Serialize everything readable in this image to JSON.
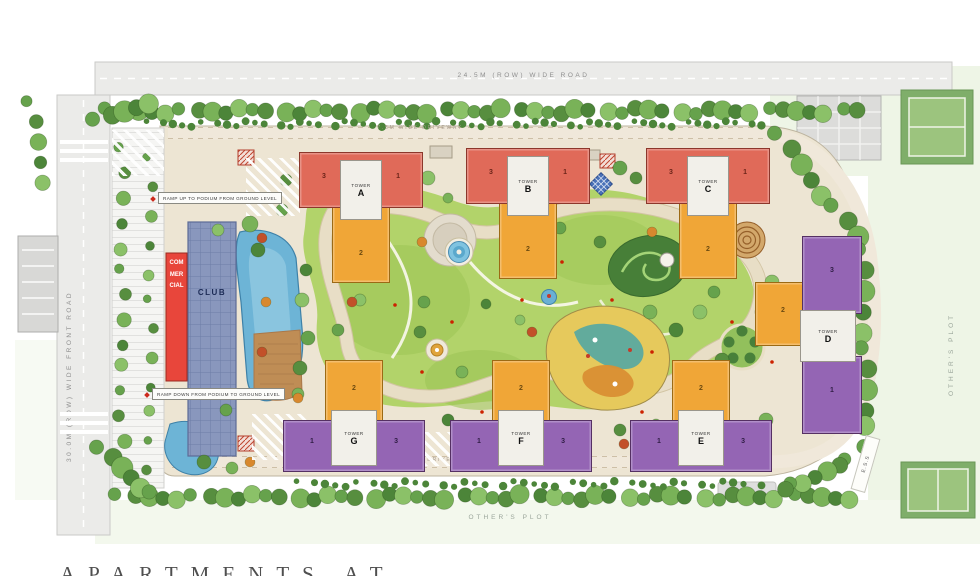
{
  "roads": {
    "top": "24.5M (ROW) WIDE ROAD",
    "left": "30.0M (ROW) WIDE FRONT ROAD",
    "driveway_top": "7.5M WIDE DRIVEWAY",
    "driveway_bottom": "7.5M WIDE DRIVEWAY"
  },
  "ramps": {
    "up": "RAMP UP TO PODIUM FROM GROUND LEVEL",
    "down": "RAMP DOWN FROM PODIUM TO GROUND LEVEL"
  },
  "club": {
    "label": "CLUB"
  },
  "commercial": {
    "label": "COMMERCIAL"
  },
  "ess": {
    "label": "E.S.S"
  },
  "plots": {
    "bottom": "OTHER'S PLOT",
    "right": "OTHER'S PLOT"
  },
  "towers": [
    {
      "label": "TOWER",
      "letter": "A",
      "wing_left": "3",
      "wing_right": "1",
      "wing_mid": "2"
    },
    {
      "label": "TOWER",
      "letter": "B",
      "wing_left": "3",
      "wing_right": "1",
      "wing_mid": "2"
    },
    {
      "label": "TOWER",
      "letter": "C",
      "wing_left": "3",
      "wing_right": "1",
      "wing_mid": "2"
    },
    {
      "label": "TOWER",
      "letter": "D",
      "wing_top": "3",
      "wing_bottom": "1",
      "wing_mid": "2"
    },
    {
      "label": "TOWER",
      "letter": "E",
      "wing_left": "1",
      "wing_right": "3",
      "wing_mid": "2"
    },
    {
      "label": "TOWER",
      "letter": "F",
      "wing_left": "1",
      "wing_right": "3",
      "wing_mid": "2"
    },
    {
      "label": "TOWER",
      "letter": "G",
      "wing_left": "1",
      "wing_right": "3",
      "wing_mid": "2"
    }
  ],
  "caption": "APARTMENTS AT",
  "colors": {
    "tower_red": "#e06a59",
    "tower_orange": "#f0a637",
    "tower_purple": "#9465b4",
    "club_blue": "#8997bd",
    "commercial_red": "#e8463b",
    "pool_blue": "#6db4d6",
    "lawn_green": "#b2d36a"
  }
}
